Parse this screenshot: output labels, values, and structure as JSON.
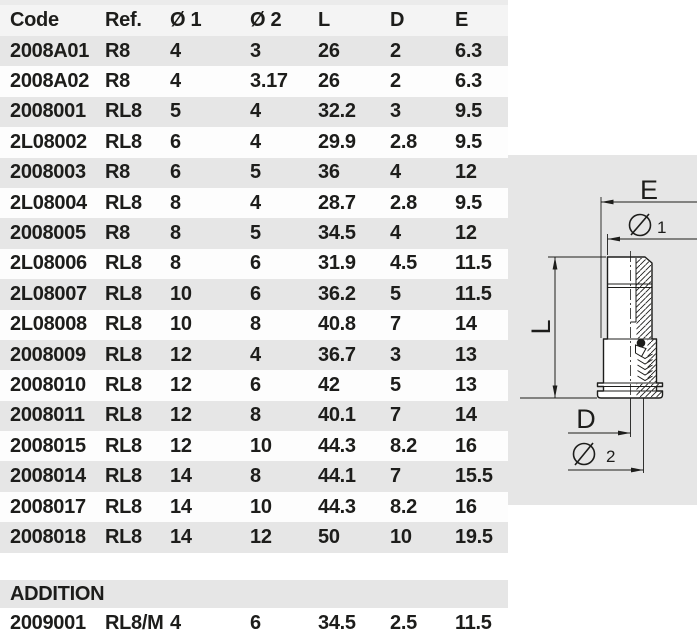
{
  "table": {
    "columns": [
      "Code",
      "Ref.",
      "Ø 1",
      "Ø 2",
      "L",
      "D",
      "E"
    ],
    "rows": [
      [
        "2008A01",
        "R8",
        "4",
        "3",
        "26",
        "2",
        "6.3"
      ],
      [
        "2008A02",
        "R8",
        "4",
        "3.17",
        "26",
        "2",
        "6.3"
      ],
      [
        "2008001",
        "RL8",
        "5",
        "4",
        "32.2",
        "3",
        "9.5"
      ],
      [
        "2L08002",
        "RL8",
        "6",
        "4",
        "29.9",
        "2.8",
        "9.5"
      ],
      [
        "2008003",
        "R8",
        "6",
        "5",
        "36",
        "4",
        "12"
      ],
      [
        "2L08004",
        "RL8",
        "8",
        "4",
        "28.7",
        "2.8",
        "9.5"
      ],
      [
        "2008005",
        "R8",
        "8",
        "5",
        "34.5",
        "4",
        "12"
      ],
      [
        "2L08006",
        "RL8",
        "8",
        "6",
        "31.9",
        "4.5",
        "11.5"
      ],
      [
        "2L08007",
        "RL8",
        "10",
        "6",
        "36.2",
        "5",
        "11.5"
      ],
      [
        "2L08008",
        "RL8",
        "10",
        "8",
        "40.8",
        "7",
        "14"
      ],
      [
        "2008009",
        "RL8",
        "12",
        "4",
        "36.7",
        "3",
        "13"
      ],
      [
        "2008010",
        "RL8",
        "12",
        "6",
        "42",
        "5",
        "13"
      ],
      [
        "2008011",
        "RL8",
        "12",
        "8",
        "40.1",
        "7",
        "14"
      ],
      [
        "2008015",
        "RL8",
        "12",
        "10",
        "44.3",
        "8.2",
        "16"
      ],
      [
        "2008014",
        "RL8",
        "14",
        "8",
        "44.1",
        "7",
        "15.5"
      ],
      [
        "2008017",
        "RL8",
        "14",
        "10",
        "44.3",
        "8.2",
        "16"
      ],
      [
        "2008018",
        "RL8",
        "14",
        "12",
        "50",
        "10",
        "19.5"
      ]
    ]
  },
  "addition": {
    "label": "ADDITION",
    "rows": [
      [
        "2009001",
        "RL8/M",
        "4",
        "6",
        "34.5",
        "2.5",
        "11.5"
      ]
    ]
  },
  "diagram": {
    "labels": {
      "e": "E",
      "d1_num": "1",
      "l": "L",
      "d": "D",
      "d2_num": "2"
    }
  },
  "colors": {
    "row_gray": "#e6e6e6",
    "row_white": "#fdfdfd",
    "header_bg": "#f4f4f4",
    "panel_gray": "#e6e6e6",
    "text": "#1d1d1b",
    "line": "#1d1d1b"
  }
}
